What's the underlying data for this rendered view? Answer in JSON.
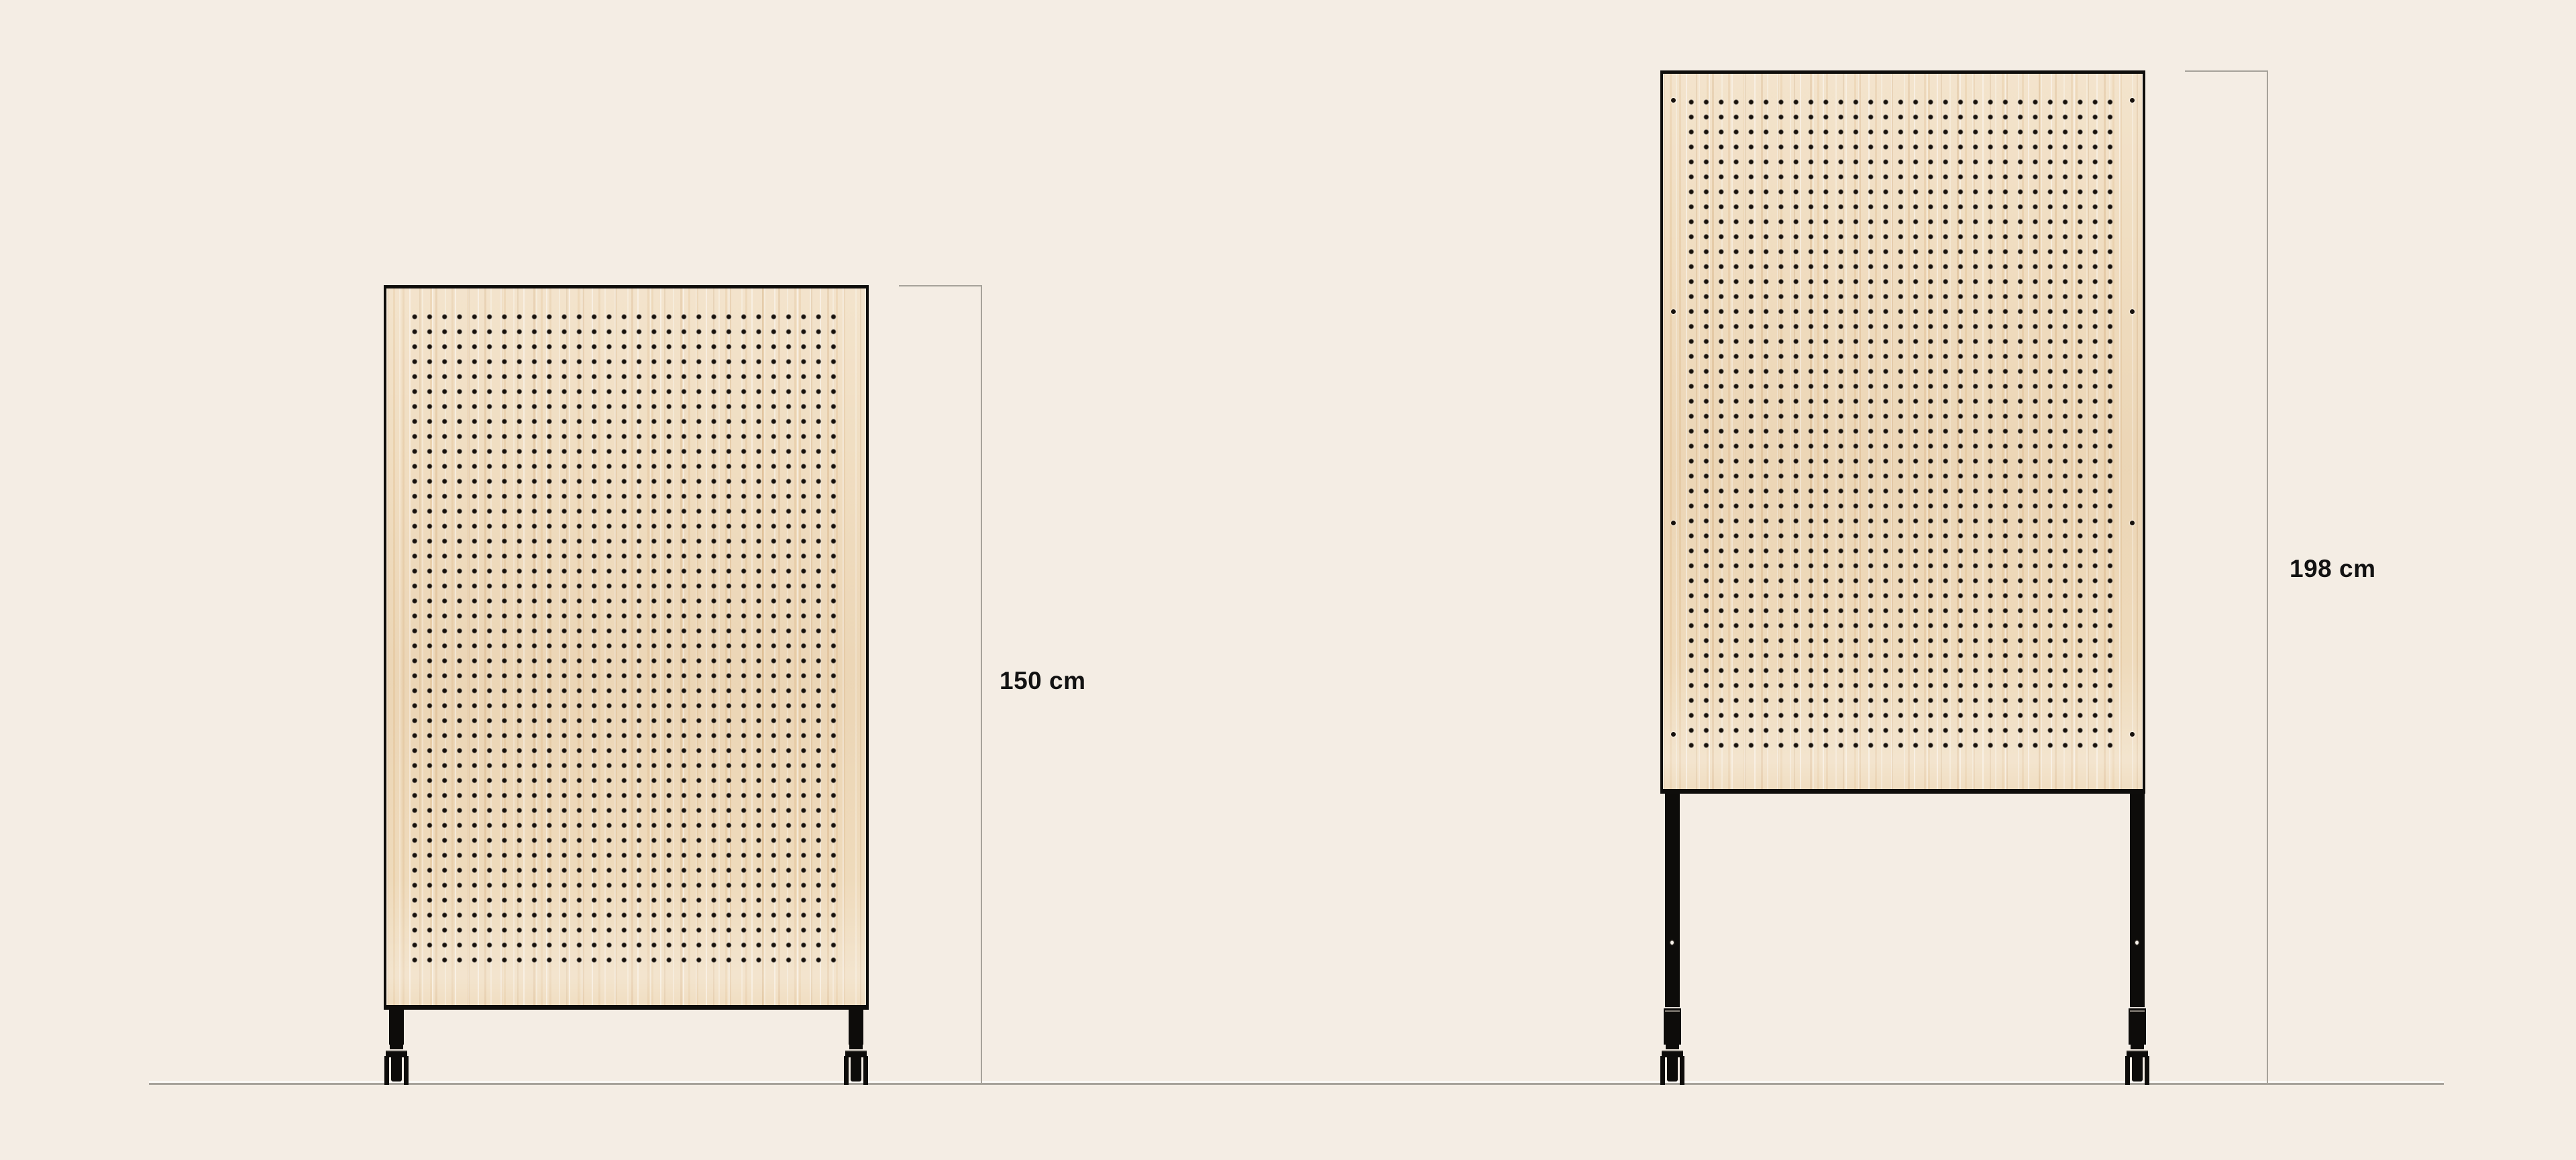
{
  "diagram": {
    "panels": [
      {
        "id": "pegboard-short-on-casters",
        "height_label": "150 cm"
      },
      {
        "id": "pegboard-tall-on-legs",
        "height_label": "198 cm"
      }
    ],
    "colors": {
      "background": "#f4ede4",
      "wood": "#efdcbd",
      "outline_black": "#0e0d0b",
      "hole_black": "#17110c",
      "dimension_line_gray": "#a6a29a",
      "label_text": "#121212"
    }
  }
}
